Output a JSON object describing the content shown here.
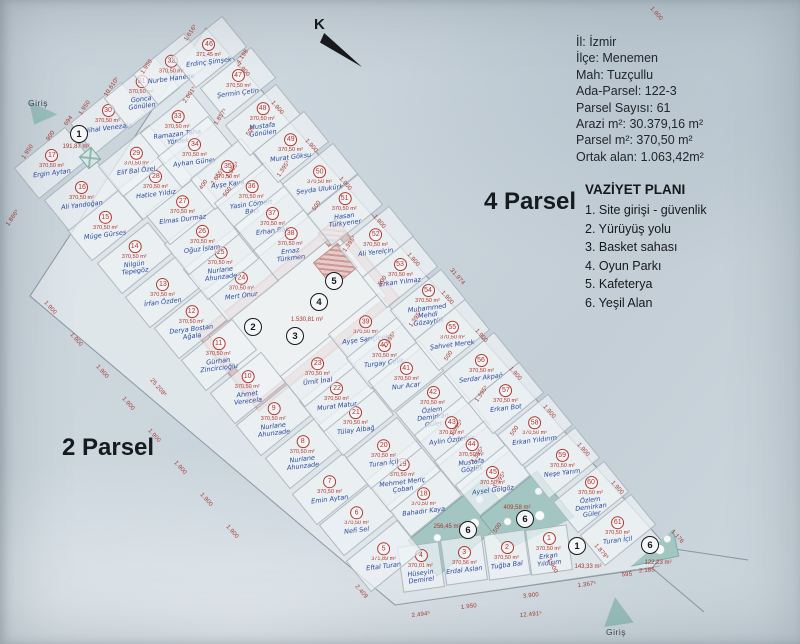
{
  "info_box": {
    "lines": [
      "İl: İzmir",
      "İlçe: Menemen",
      "Mah: Tuzçullu",
      "Ada-Parsel: 122-3",
      "Parsel Sayısı: 61",
      "Arazi m²: 30.379,16 m²",
      "Parsel m²: 370,50 m²",
      "Ortak alan: 1.063,42m²"
    ]
  },
  "legend": {
    "title": "VAZİYET PLANI",
    "items": [
      "1. Site girişi - güvenlik",
      "2. Yürüyüş yolu",
      "3. Basket sahası",
      "4. Oyun Parkı",
      "5. Kafeterya",
      "6. Yeşil Alan"
    ]
  },
  "labels": {
    "north": "K",
    "parsel_right": "4 Parsel",
    "parsel_left": "2 Parsel",
    "entrance_top": "Giriş",
    "entrance_bottom": "Giriş"
  },
  "colors": {
    "red_annotation": "#b1382e",
    "blue_handwriting": "#2b4a9e",
    "teal_green_area": "#a3c6c2",
    "pink_facility": "#cc9794",
    "paper": "#ccd6dd"
  },
  "plan": {
    "default_area": "370,50 m²",
    "central_area_label": "1.530,81 m²",
    "parcels": [
      {
        "n": 1,
        "name": "Erkan Yıldırım",
        "x": 549,
        "y": 550,
        "r": -8,
        "w": 40,
        "h": 44
      },
      {
        "n": 2,
        "name": "Tuğba Bal",
        "x": 507,
        "y": 555,
        "r": -8,
        "w": 40,
        "h": 44
      },
      {
        "n": 3,
        "name": "Erdal Aslan",
        "area": "370,56 m²",
        "x": 464,
        "y": 560,
        "r": -8,
        "w": 40,
        "h": 44
      },
      {
        "n": 4,
        "name": "Hüseyin Demirel",
        "area": "370,01 m²",
        "x": 421,
        "y": 567,
        "r": -8,
        "w": 40,
        "h": 44
      },
      {
        "n": 5,
        "name": "Eftal Turan",
        "area": "371,89 m²",
        "x": 384,
        "y": 556
      },
      {
        "n": 6,
        "name": "Nefi Sel",
        "x": 357,
        "y": 520
      },
      {
        "n": 7,
        "name": "Emin Aytan",
        "x": 330,
        "y": 489
      },
      {
        "n": 8,
        "name": "Nurlane Ahunzade",
        "x": 303,
        "y": 453
      },
      {
        "n": 9,
        "name": "Nurlane Ahunzade",
        "x": 274,
        "y": 420
      },
      {
        "n": 10,
        "name": "Ahmet Verecela",
        "x": 248,
        "y": 388
      },
      {
        "n": 11,
        "name": "Gürhan Zincircioğlu",
        "x": 219,
        "y": 355
      },
      {
        "n": 12,
        "name": "Derya Bostan Ağala",
        "x": 192,
        "y": 323
      },
      {
        "n": 13,
        "name": "İrfan Özden",
        "x": 163,
        "y": 292
      },
      {
        "n": 14,
        "name": "Nilgün Tepegöz",
        "x": 135,
        "y": 258
      },
      {
        "n": 15,
        "name": "Müge Gürses",
        "x": 105,
        "y": 225
      },
      {
        "n": 16,
        "name": "Ali Yandoğan",
        "x": 82,
        "y": 195
      },
      {
        "n": 17,
        "name": "Ergin Aytan",
        "x": 52,
        "y": 163
      },
      {
        "n": 18,
        "name": "Bahadır Kaya",
        "x": 424,
        "y": 501
      },
      {
        "n": 19,
        "name": "Mehmet Meriç Çoban",
        "x": 403,
        "y": 476
      },
      {
        "n": 20,
        "name": "Turan İçil",
        "x": 384,
        "y": 453
      },
      {
        "n": 21,
        "name": "Tülay Albağ",
        "x": 356,
        "y": 420
      },
      {
        "n": 22,
        "name": "Murat Matur",
        "x": 337,
        "y": 396
      },
      {
        "n": 23,
        "name": "Ümit İnal",
        "x": 318,
        "y": 371
      },
      {
        "n": 24,
        "name": "Mert Onur",
        "x": 241,
        "y": 286
      },
      {
        "n": 25,
        "name": "Nurlane Ahunzade",
        "x": 221,
        "y": 264
      },
      {
        "n": 26,
        "name": "Oğuz İslam",
        "x": 202,
        "y": 239
      },
      {
        "n": 27,
        "name": "Elmas Durmaz",
        "x": 183,
        "y": 209
      },
      {
        "n": 28,
        "name": "Hatice Yıldız",
        "x": 156,
        "y": 184
      },
      {
        "n": 29,
        "name": "Elif Bal Özel",
        "x": 136,
        "y": 161
      },
      {
        "n": 30,
        "name": "Nihal Venezala",
        "x": 108,
        "y": 118
      },
      {
        "n": 31,
        "name": "Gonca Gönülen",
        "x": 142,
        "y": 93
      },
      {
        "n": 32,
        "name": "Nurbe Hanede",
        "x": 171,
        "y": 69
      },
      {
        "n": 33,
        "name": "Ramazan Taha Yördek",
        "x": 178,
        "y": 128
      },
      {
        "n": 34,
        "name": "Ayhan Güney",
        "x": 195,
        "y": 152
      },
      {
        "n": 35,
        "name": "Ayşe Kaya",
        "x": 228,
        "y": 174
      },
      {
        "n": 36,
        "name": "Yasin Cömert Bacı",
        "x": 252,
        "y": 198
      },
      {
        "n": 37,
        "name": "Erhan Bat",
        "x": 272,
        "y": 221
      },
      {
        "n": 38,
        "name": "Ernaz Türkmen",
        "x": 291,
        "y": 245
      },
      {
        "n": 39,
        "name": "Ayşe Sarıçiçek",
        "x": 366,
        "y": 329
      },
      {
        "n": 40,
        "name": "Turgay Çelik",
        "x": 384,
        "y": 353
      },
      {
        "n": 41,
        "name": "Nur Acar",
        "x": 406,
        "y": 376
      },
      {
        "n": 42,
        "name": "Özlem Demirkan Güler",
        "x": 433,
        "y": 407
      },
      {
        "n": 43,
        "name": "Aylin Özdemir",
        "x": 452,
        "y": 430
      },
      {
        "n": 44,
        "name": "Mustafa Gözlük",
        "x": 472,
        "y": 456
      },
      {
        "n": 45,
        "name": "Aysel Gölgöz",
        "x": 493,
        "y": 480
      },
      {
        "n": 46,
        "name": "Erdinç Şimşek",
        "area": "371,45 m²",
        "x": 209,
        "y": 52
      },
      {
        "n": 47,
        "name": "Şermin Çetin",
        "x": 238,
        "y": 83
      },
      {
        "n": 48,
        "name": "Mustafa Gönülen",
        "x": 263,
        "y": 120
      },
      {
        "n": 49,
        "name": "Murat Göksu",
        "x": 291,
        "y": 147
      },
      {
        "n": 50,
        "name": "Şeyda Ulukürk",
        "x": 320,
        "y": 179
      },
      {
        "n": 51,
        "name": "Hasan Türkyener",
        "x": 345,
        "y": 210
      },
      {
        "n": 52,
        "name": "Ali Yerelçin",
        "x": 376,
        "y": 242
      },
      {
        "n": 53,
        "name": "Erkan Yılmaz",
        "x": 400,
        "y": 272
      },
      {
        "n": 54,
        "name": "Muhammed Mehdi Gözaytük",
        "x": 428,
        "y": 305
      },
      {
        "n": 55,
        "name": "Şahvet Merek",
        "x": 452,
        "y": 335
      },
      {
        "n": 56,
        "name": "Serdar Akpağ",
        "x": 481,
        "y": 368
      },
      {
        "n": 57,
        "name": "Erkan Bot",
        "x": 506,
        "y": 398
      },
      {
        "n": 58,
        "name": "Erkan Yıldırım",
        "x": 535,
        "y": 430
      },
      {
        "n": 59,
        "name": "Neşe Yarım",
        "x": 562,
        "y": 463
      },
      {
        "n": 60,
        "name": "Özlem Demirkan Güler",
        "x": 591,
        "y": 497
      },
      {
        "n": 61,
        "name": "Turan İçil",
        "x": 618,
        "y": 530
      }
    ],
    "commons": [
      {
        "n": "1",
        "x": 79,
        "y": 134,
        "area": "191,87 m²",
        "lx": 76,
        "ly": 147
      },
      {
        "n": "2",
        "x": 253,
        "y": 327
      },
      {
        "n": "3",
        "x": 295,
        "y": 336
      },
      {
        "n": "4",
        "x": 319,
        "y": 302
      },
      {
        "n": "5",
        "x": 334,
        "y": 281
      },
      {
        "area": "1.530,81 m²",
        "lx": 307,
        "ly": 320
      },
      {
        "n": "6",
        "x": 468,
        "y": 530,
        "area": "256,45 m²",
        "lx": 447,
        "ly": 527
      },
      {
        "n": "6",
        "x": 525,
        "y": 519,
        "area": "409,58 m²",
        "lx": 517,
        "ly": 508
      },
      {
        "n": "6",
        "x": 650,
        "y": 545,
        "area": "122,23 m²",
        "lx": 658,
        "ly": 563
      },
      {
        "n": "1",
        "x": 577,
        "y": 546,
        "area": "143,33 m²",
        "lx": 588,
        "ly": 567
      }
    ],
    "dims": [
      {
        "t": "1.616⁵",
        "x": 191,
        "y": 33,
        "r": -56
      },
      {
        "t": "4.198",
        "x": 243,
        "y": 57,
        "r": -56
      },
      {
        "t": "1.950",
        "x": 147,
        "y": 67,
        "r": -56
      },
      {
        "t": "10.610⁵",
        "x": 112,
        "y": 87,
        "r": -56
      },
      {
        "t": "1.950",
        "x": 85,
        "y": 108,
        "r": -56
      },
      {
        "t": "694",
        "x": 69,
        "y": 121,
        "r": -56
      },
      {
        "t": "900",
        "x": 51,
        "y": 136,
        "r": -56
      },
      {
        "t": "1.950",
        "x": 28,
        "y": 152,
        "r": -56
      },
      {
        "t": "1.857⁵",
        "x": 221,
        "y": 117,
        "r": -56
      },
      {
        "t": "1.866⁵",
        "x": 13,
        "y": 218,
        "r": -56
      },
      {
        "t": "2.601⁵",
        "x": 190,
        "y": 95,
        "r": -56
      },
      {
        "t": "2.655⁵",
        "x": 218,
        "y": 177,
        "r": -56
      },
      {
        "t": "400",
        "x": 204,
        "y": 185,
        "r": -56
      },
      {
        "t": "500",
        "x": 228,
        "y": 192,
        "r": -56
      },
      {
        "t": "1.395⁵",
        "x": 233,
        "y": 170,
        "r": -56
      },
      {
        "t": "31.974",
        "x": 457,
        "y": 277,
        "r": 49
      },
      {
        "t": "1.176",
        "x": 677,
        "y": 537,
        "r": 49
      },
      {
        "t": "1.879⁵",
        "x": 601,
        "y": 552,
        "r": 49
      },
      {
        "t": "25.208⁵",
        "x": 158,
        "y": 388,
        "r": 49
      },
      {
        "t": "2.409",
        "x": 361,
        "y": 592,
        "r": 49
      },
      {
        "t": "500",
        "x": 498,
        "y": 528,
        "r": -56
      },
      {
        "t": "1.900",
        "x": 552,
        "y": 566,
        "r": 62
      },
      {
        "t": "2.494⁵",
        "x": 421,
        "y": 615,
        "r": -7
      },
      {
        "t": "1.950",
        "x": 469,
        "y": 607,
        "r": -7
      },
      {
        "t": "3.900",
        "x": 531,
        "y": 596,
        "r": -6
      },
      {
        "t": "12.491⁵",
        "x": 531,
        "y": 615,
        "r": -6
      },
      {
        "t": "1.367⁵",
        "x": 587,
        "y": 585,
        "r": -7
      },
      {
        "t": "595",
        "x": 627,
        "y": 575,
        "r": -4
      },
      {
        "t": "2.185",
        "x": 647,
        "y": 571,
        "r": -4
      },
      {
        "t": "1.900",
        "x": 656,
        "y": 14,
        "r": 49
      },
      {
        "t": "1.900",
        "x": 243,
        "y": 70,
        "r": 49
      },
      {
        "t": "1.900",
        "x": 277,
        "y": 108,
        "r": 49
      },
      {
        "t": "1.900",
        "x": 311,
        "y": 146,
        "r": 49
      },
      {
        "t": "1.900",
        "x": 345,
        "y": 184,
        "r": 49
      },
      {
        "t": "1.900",
        "x": 379,
        "y": 222,
        "r": 49
      },
      {
        "t": "1.900",
        "x": 413,
        "y": 260,
        "r": 49
      },
      {
        "t": "1.900",
        "x": 447,
        "y": 298,
        "r": 49
      },
      {
        "t": "1.900",
        "x": 481,
        "y": 336,
        "r": 49
      },
      {
        "t": "1.900",
        "x": 515,
        "y": 374,
        "r": 49
      },
      {
        "t": "1.900",
        "x": 549,
        "y": 412,
        "r": 49
      },
      {
        "t": "1.900",
        "x": 583,
        "y": 450,
        "r": 49
      },
      {
        "t": "1.900",
        "x": 617,
        "y": 488,
        "r": 49
      },
      {
        "t": "1.900",
        "x": 50,
        "y": 308,
        "r": 49
      },
      {
        "t": "1.900",
        "x": 76,
        "y": 340,
        "r": 49
      },
      {
        "t": "1.900",
        "x": 102,
        "y": 372,
        "r": 49
      },
      {
        "t": "1.900",
        "x": 128,
        "y": 404,
        "r": 49
      },
      {
        "t": "1.900",
        "x": 154,
        "y": 436,
        "r": 49
      },
      {
        "t": "1.900",
        "x": 180,
        "y": 468,
        "r": 49
      },
      {
        "t": "1.900",
        "x": 206,
        "y": 500,
        "r": 49
      },
      {
        "t": "1.900",
        "x": 232,
        "y": 532,
        "r": 49
      },
      {
        "t": "1.395⁵",
        "x": 284,
        "y": 169,
        "r": -56
      },
      {
        "t": "1.395⁵",
        "x": 350,
        "y": 244,
        "r": -56
      },
      {
        "t": "1.395⁵",
        "x": 416,
        "y": 319,
        "r": -56
      },
      {
        "t": "1.395⁵",
        "x": 482,
        "y": 394,
        "r": -56
      },
      {
        "t": "500",
        "x": 251,
        "y": 131,
        "r": -56
      },
      {
        "t": "500",
        "x": 317,
        "y": 206,
        "r": -56
      },
      {
        "t": "500",
        "x": 383,
        "y": 281,
        "r": -56
      },
      {
        "t": "500",
        "x": 449,
        "y": 356,
        "r": -56
      },
      {
        "t": "500",
        "x": 515,
        "y": 431,
        "r": -56
      },
      {
        "t": "1.395⁵",
        "x": 457,
        "y": 428,
        "r": -56
      },
      {
        "t": "1.395⁵",
        "x": 478,
        "y": 455,
        "r": -56
      },
      {
        "t": "1.395⁵",
        "x": 500,
        "y": 480,
        "r": -56
      },
      {
        "t": "1.395⁵",
        "x": 390,
        "y": 340,
        "r": -56
      }
    ]
  }
}
